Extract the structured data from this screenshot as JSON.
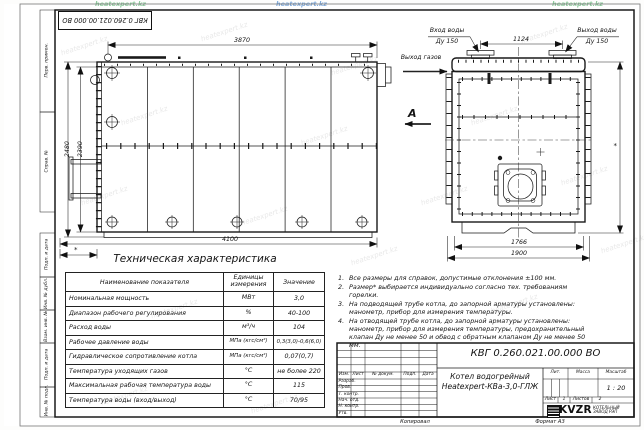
{
  "doc": {
    "number": "КВГ 0.260.021.00.000 ВО",
    "name_line1": "Котел водогрейный",
    "name_line2": "Heatexpert-КВа-3,0-ГЛЖ",
    "lit_label": "Лит.",
    "mass_label": "Масса",
    "scale_label": "Масштаб",
    "scale": "1 : 20",
    "sheet_label": "Лист",
    "sheet_no": "1",
    "sheets_label": "Листов",
    "sheets_no": "2",
    "copied": "Копировал",
    "format": "Формат А3",
    "logo_text": "KVZR",
    "logo_sub1": "КОТЕЛЬНЫЙ",
    "logo_sub2": "ЗАВОД РЭП"
  },
  "title_block": {
    "header_cols": [
      "Изм.",
      "Лист",
      "№ докум.",
      "Подп.",
      "Дата"
    ],
    "roles": [
      "Разраб.",
      "Пров.",
      "Т. контр.",
      "Нач. отд.",
      "Н. контр.",
      "Утв."
    ]
  },
  "frame": {
    "top_stamp": "КВГ 0.260.021.00.000 ВО",
    "left_labels": [
      "Перв. примен.",
      "Справ. №",
      "Подп. и дата",
      "Инв. № дубл.",
      "Взам. инв. №",
      "Подп. и дата",
      "Инв. № подл."
    ]
  },
  "drawing": {
    "dims": {
      "length_top": "3870",
      "height_outer": "2480",
      "height_inner": "2390",
      "length_bottom": "4100",
      "width_top": "1124",
      "width_inner": "1766",
      "width_outer": "1900",
      "star": "*"
    },
    "labels": {
      "water_in": "Вход воды",
      "water_in_dn": "Ду 150",
      "water_out": "Выход воды",
      "water_out_dn": "Ду 150",
      "gas_out": "Выход газов",
      "view": "А"
    }
  },
  "table": {
    "title": "Техническая характеристика",
    "headers": [
      "Наименование показателя",
      "Единицы измерения",
      "Значение"
    ],
    "rows": [
      {
        "name": "Номинальная мощность",
        "unit": "МВт",
        "value": "3,0"
      },
      {
        "name": "Диапазон рабочего регулирования",
        "unit": "%",
        "value": "40-100"
      },
      {
        "name": "Расход воды",
        "unit": "м³/ч",
        "value": "104"
      },
      {
        "name": "Рабочее давление воды",
        "unit": "МПа (кгс/см²)",
        "value": "0,3(3,0)-0,6(6,0)"
      },
      {
        "name": "Гидравлическое сопротивление котла",
        "unit": "МПа (кгс/см²)",
        "value": "0,07(0,7)"
      },
      {
        "name": "Температура уходящих газов",
        "unit": "°С",
        "value": "не более 220"
      },
      {
        "name": "Максимальная рабочая температура воды",
        "unit": "°С",
        "value": "115"
      },
      {
        "name": "Температура воды (вход/выход)",
        "unit": "°С",
        "value": "70/95"
      }
    ]
  },
  "notes": [
    {
      "num": "1.",
      "text": "Все размеры для справок, допустимые отклонения ±100 мм."
    },
    {
      "num": "2.",
      "text": "Размер* выбирается индивидуально согласно тех. требованиям горелки."
    },
    {
      "num": "3.",
      "text": "На подводящей трубе котла, до запорной арматуры установлены: манометр, прибор для измерения температуры."
    },
    {
      "num": "4.",
      "text": "На отводящей трубе котла, до запорной арматуры установлены: манометр, прибор для измерения температуры, предохранительный клапан Ду не менее 50 и обвод с обратным клапаном Ду не менее 50 мм."
    }
  ],
  "watermark": "heatexpert.kz"
}
